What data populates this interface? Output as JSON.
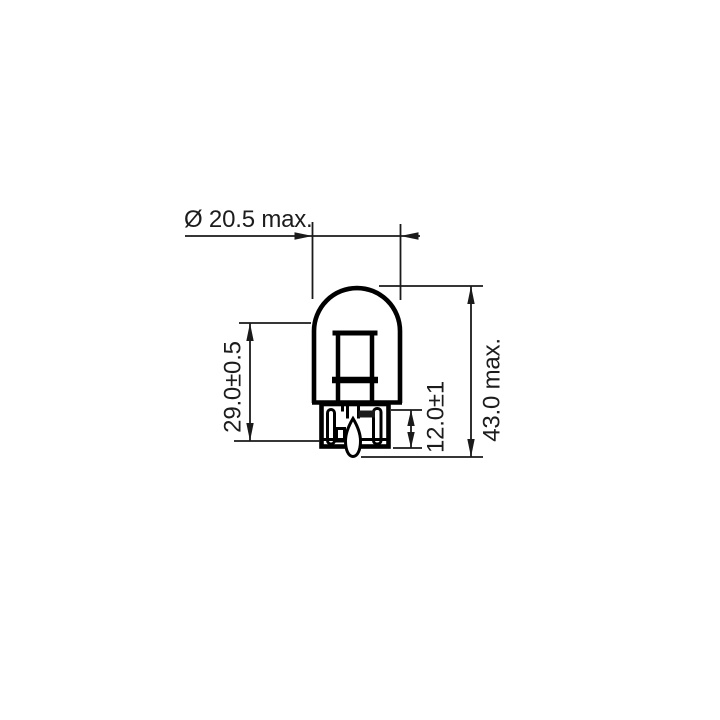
{
  "page": {
    "background_color": "#ffffff",
    "line_color": "#000000",
    "text_color": "#1c1c1c"
  },
  "diagram": {
    "kind": "technical-dimension-drawing",
    "subject": "wedge-base-bulb",
    "labels": {
      "diameter": "Ø 20.5 max.",
      "bulb_length": "29.0±0.5",
      "overall_length": "43.0 max.",
      "base_height": "12.0±1"
    }
  }
}
